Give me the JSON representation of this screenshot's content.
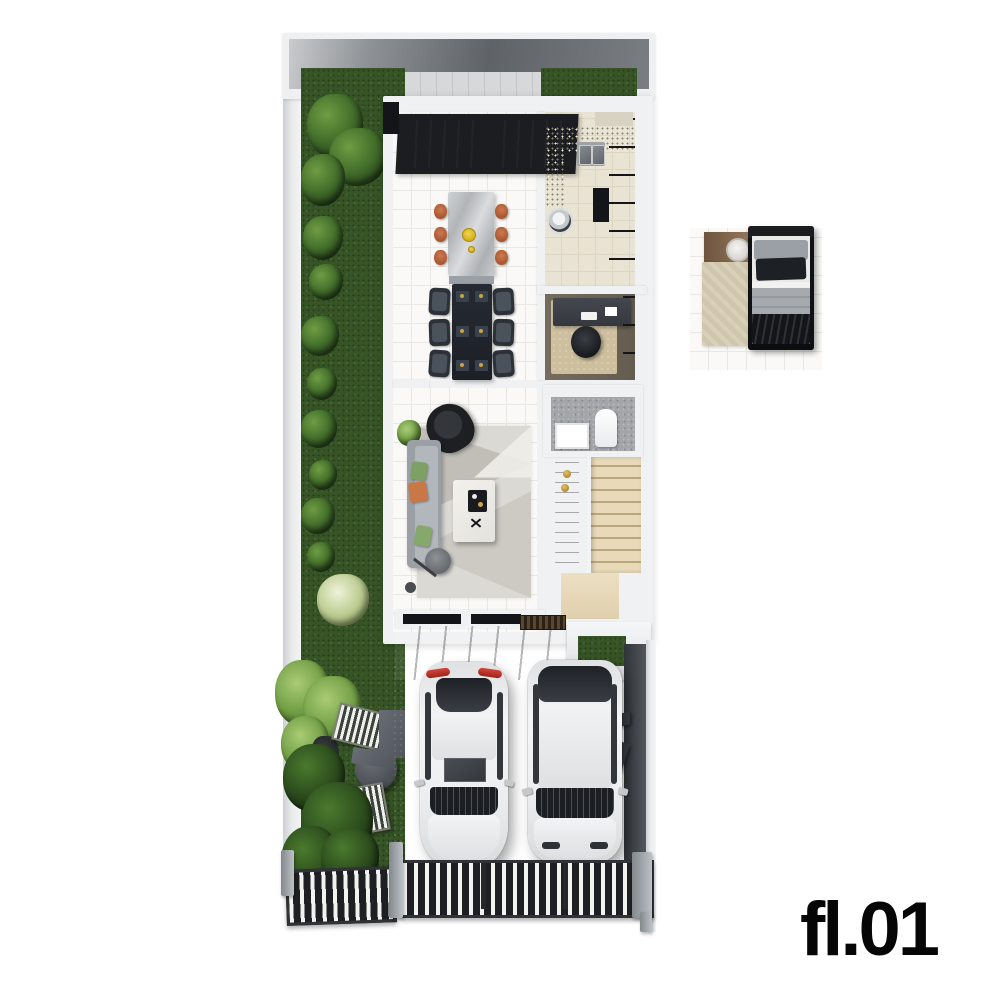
{
  "floor_label": "fl.01",
  "scene": {
    "description": "3D top-down architectural render of the first floor of a narrow townhouse",
    "rooms": [
      "back patio",
      "kitchen",
      "dining area",
      "study",
      "living room",
      "bathroom",
      "staircase",
      "entry porch",
      "two-car garage",
      "side garden",
      "driveway grates",
      "bedroom furniture detail"
    ],
    "furniture": [
      "marble kitchen island with six orange stools",
      "fruit bowl",
      "dark dining table with six chairs",
      "L-shaped kitchen counter with double sink",
      "washing machine",
      "tall dark cabinets and fridge",
      "study desk with office chair",
      "gray sofa with green and orange pillows",
      "black armchair",
      "geometric area rug",
      "white marble coffee table with black tray",
      "floor lamp",
      "potted plant",
      "toilet",
      "vanity sink",
      "dark media wall with gold sconces",
      "wood staircase",
      "two striped lounge chairs",
      "round garden table",
      "single bed with black duvet",
      "wood nightstand with round tray",
      "beige bedside rug"
    ],
    "vehicles": [
      "white sedan (rear to street)",
      "white SUV (rear to street)"
    ],
    "colors": {
      "background": "#ffffff",
      "grass": "#365426",
      "hedge": "#24401a",
      "pale_tree": "#c6d49e",
      "walls": "#eff1f2",
      "roof_shadow": "#5f6368",
      "wood_stairs": "#e3d2ae",
      "stool_orange": "#b4613c",
      "pillow_green": "#7da164",
      "pillow_orange": "#c87847",
      "fruit_bowl_yellow": "#e8c421",
      "garage_concrete": "#a9afb6",
      "porch_tile": "#4a4e54",
      "taillight_red": "#c23429",
      "gold_accent": "#c09a3e",
      "label_text": "#060606"
    }
  }
}
